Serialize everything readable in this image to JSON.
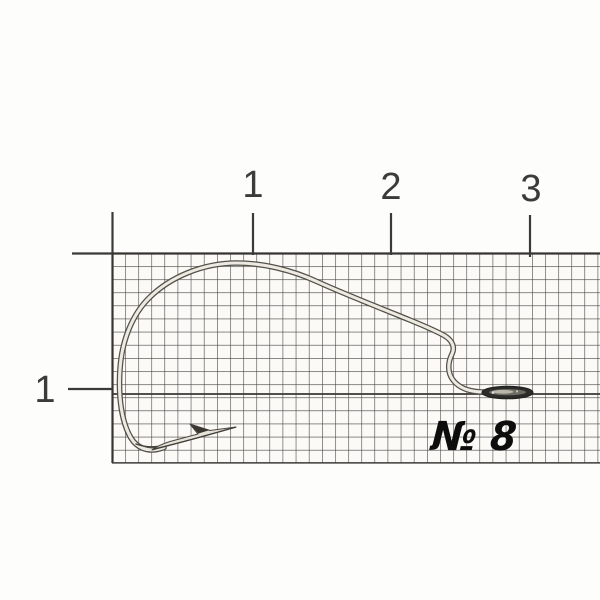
{
  "scene": {
    "description": "Product photograph of a single offset worm fishing hook lying on millimeter graph paper with centimeter ruler marks",
    "object": "offset worm fishing hook",
    "size_label": "№ 8"
  },
  "ruler": {
    "top_ticks": [
      {
        "label": "1"
      },
      {
        "label": "2"
      },
      {
        "label": "3"
      }
    ],
    "left_ticks": [
      {
        "label": "1"
      }
    ]
  },
  "colors": {
    "background": "#fdfdfc",
    "paper": "#fbfaf7",
    "grid_line": "#42413e",
    "grid_border": "#353431",
    "tick_mark": "#3a3a3a",
    "tick_label": "#3b3b3b",
    "size_label": "#0d0d0d",
    "hook_wire_light": "#edebe1",
    "hook_wire_dark": "#53504a",
    "hook_point_fill": "#e6e4da",
    "hook_eye_dark": "#2c2c2a",
    "hook_eye_slot": "#6e6c64"
  }
}
